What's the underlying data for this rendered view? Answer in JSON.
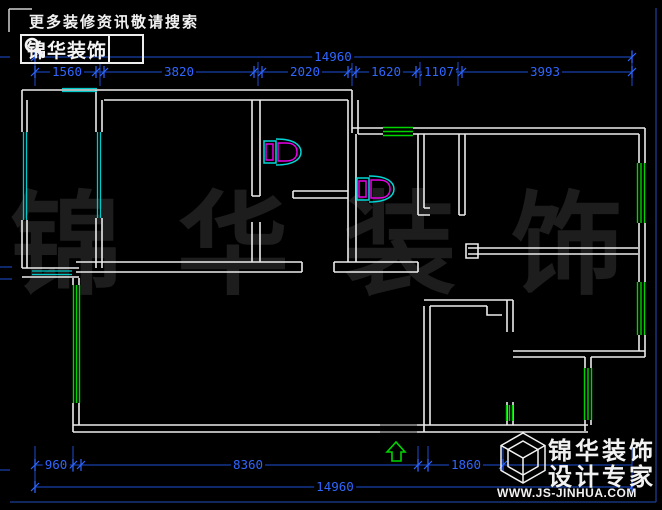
{
  "header": {
    "slogan": "更多装修资讯敬请搜索",
    "logo_text": "锦华装饰",
    "search_icon": "magnifier"
  },
  "watermark": {
    "text": "锦华装饰"
  },
  "footer": {
    "brand": "锦华装饰",
    "tagline": "设计专家",
    "website": "WWW.JS-JINHUA.COM",
    "logo_icon": "wireframe-cube"
  },
  "dims": {
    "top_total": "14960",
    "top_segments": [
      "1560",
      "3820",
      "2020",
      "1620",
      "1107",
      "3993"
    ],
    "bottom_segments": [
      "960",
      "8360",
      "1860"
    ],
    "bottom_total": "14960"
  },
  "plan": {
    "type": "floor-plan",
    "fixtures": [
      "toilet",
      "toilet"
    ],
    "entrance_marker": "green-up-arrow",
    "colors": {
      "walls": "#ececec",
      "exterior_windows": "#00d400",
      "balcony_windows": "#00c8c8",
      "toilet_outline": "#00d8d8",
      "toilet_fixture": "#e800e8",
      "dimensions": "#2f66ff",
      "watermark": "#1d1d1d"
    }
  }
}
